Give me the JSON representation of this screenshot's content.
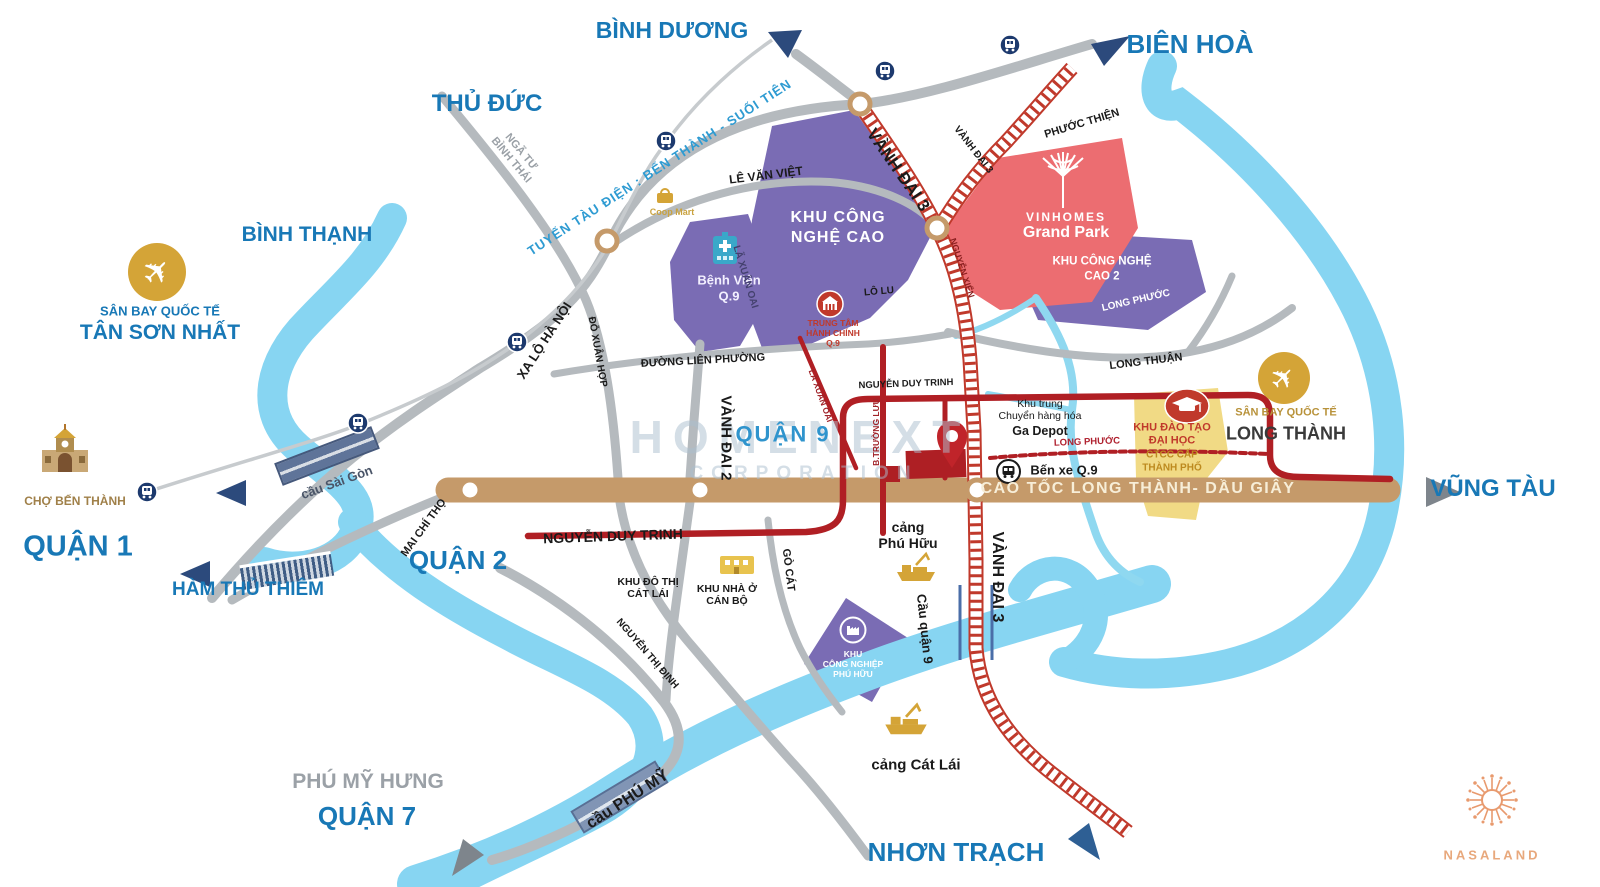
{
  "regions": {
    "binh_duong": "BÌNH DƯƠNG",
    "bien_hoa": "BIÊN HOÀ",
    "thu_duc": "THỦ ĐỨC",
    "binh_thanh": "BÌNH THẠNH",
    "quan_1": "QUẬN 1",
    "ham_thu_thiem": "HÀM THỦ THIÊM",
    "quan_2": "QUẬN 2",
    "quan_9": "QUẬN 9",
    "phu_my_hung": "PHÚ MỸ HƯNG",
    "quan_7": "QUẬN 7",
    "nhon_trach": "NHƠN TRẠCH",
    "vung_tau": "VŨNG TÀU"
  },
  "places": {
    "tsn_airport_line1": "SÂN BAY QUỐC TẾ",
    "tsn_airport_line2": "TÂN SƠN NHẤT",
    "lt_airport_line1": "SÂN BAY QUỐC TẾ",
    "lt_airport_line2": "LONG THÀNH",
    "cho_ben_thanh": "CHỢ BẾN THÀNH",
    "coop_mart": "Coop Mart",
    "benh_vien_1": "Bệnh Viện",
    "benh_vien_2": "Q.9",
    "tthc_1": "TRUNG TÂM",
    "tthc_2": "HÀNH CHÍNH",
    "tthc_3": "Q.9",
    "vinhomes": "VINHOMES",
    "grand_park": "Grand Park",
    "khu_cnc_1": "KHU CÔNG",
    "khu_cnc_2": "NGHỆ CAO",
    "khu_cnc2_1": "KHU CÔNG NGHỆ",
    "khu_cnc2_2": "CAO 2",
    "ga_depot_1": "Khu trung",
    "ga_depot_2": "Chuyển hàng hóa",
    "ga_depot_3": "Ga Depot",
    "ben_xe": "Bến xe Q.9",
    "khu_dao_tao_1": "KHU ĐÀO TẠO",
    "khu_dao_tao_2": "ĐẠI HỌC",
    "khu_dao_tao_3": "CTCC CẤP",
    "khu_dao_tao_4": "THÀNH PHỐ",
    "khu_do_thi_1": "KHU ĐÔ THỊ",
    "khu_do_thi_2": "CÁT LÁI",
    "khu_nha_o_1": "KHU NHÀ Ở",
    "khu_nha_o_2": "CÁN BỘ",
    "kcn_phu_huu_1": "KHU",
    "kcn_phu_huu_2": "CÔNG NGHIỆP",
    "kcn_phu_huu_3": "PHÚ HỮU",
    "cang_phu_huu_1": "cảng",
    "cang_phu_huu_2": "Phú Hữu",
    "cang_cat_lai": "cảng Cát Lái"
  },
  "streets": {
    "metro_line": "TUYẾN TÀU ĐIỆN : BẾN THÀNH - SUỐI TIÊN",
    "nga_tu_1": "NGÃ TƯ",
    "nga_tu_2": "BÌNH THÁI",
    "xa_lo_ha_noi": "XA LỘ HÀ NỘI",
    "le_van_viet": "LÊ VĂN VIỆT",
    "la_xuan_oai": "LÃ XUÂN OAI",
    "do_xuan_hop": "ĐỖ XUÂN HỢP",
    "duong_lien_phuong": "ĐƯỜNG LIÊN PHƯỜNG",
    "vanh_dai_2": "VÀNH ĐAI 2",
    "vanh_dai_3": "VÀNH ĐAI 3",
    "nguyen_xien": "NGUYỄN XIỂN",
    "phuoc_thien": "PHƯỚC THIỆN",
    "long_phuoc": "LONG PHƯỚC",
    "long_thuan": "LONG THUẬN",
    "lo_lu": "LÔ LU",
    "nguyen_duy_trinh": "NGUYỄN DUY TRINH",
    "b_truong_luu": "B.TRƯỜNG LƯU",
    "mai_chi_tho": "MAI CHÍ THỌ",
    "nguyen_thi_dinh": "NGUYỄN THỊ ĐỊNH",
    "go_cat": "GÒ CÁT",
    "cau_sai_gon": "cầu Sài Gòn",
    "cau_phu_my": "cầu PHÚ MỸ",
    "cau_quan_9": "Cầu quận 9",
    "cao_toc": "CAO TỐC LONG THÀNH- DẦU GIÂY"
  },
  "watermark": {
    "line1": "HOMENEXT",
    "line2": "CORPORATION"
  },
  "branding": {
    "logo_text": "NASALAND"
  },
  "colors": {
    "region_blue": "#1878b6",
    "quan9_blue": "#2f94cd",
    "muted_gray": "#9aa0a6",
    "river": "#87d5f2",
    "road_gray": "#b5babe",
    "highway_brown": "#c59a6a",
    "ring_road_red": "#c0392b",
    "project_red": "#b01f24",
    "zone_purple": "#7a6cb4",
    "zone_pink": "#ec6d71",
    "zone_yellow": "#f1da85",
    "gold": "#d4a437",
    "navy": "#2c4a7c",
    "logo_orange": "#e89a6e"
  },
  "icons": {
    "airport": "plane in gold circle",
    "metro": "train in navy circle",
    "market": "Ben Thanh facade",
    "hospital": "teal building with cross",
    "admin": "building in red circle",
    "factory": "factory in white ring",
    "education": "mortarboard in red oval",
    "bus": "bus in white circle",
    "port": "gold crane ship",
    "pin": "red location pin",
    "tree": "white stylized tree",
    "mandala": "orange flower logo"
  }
}
